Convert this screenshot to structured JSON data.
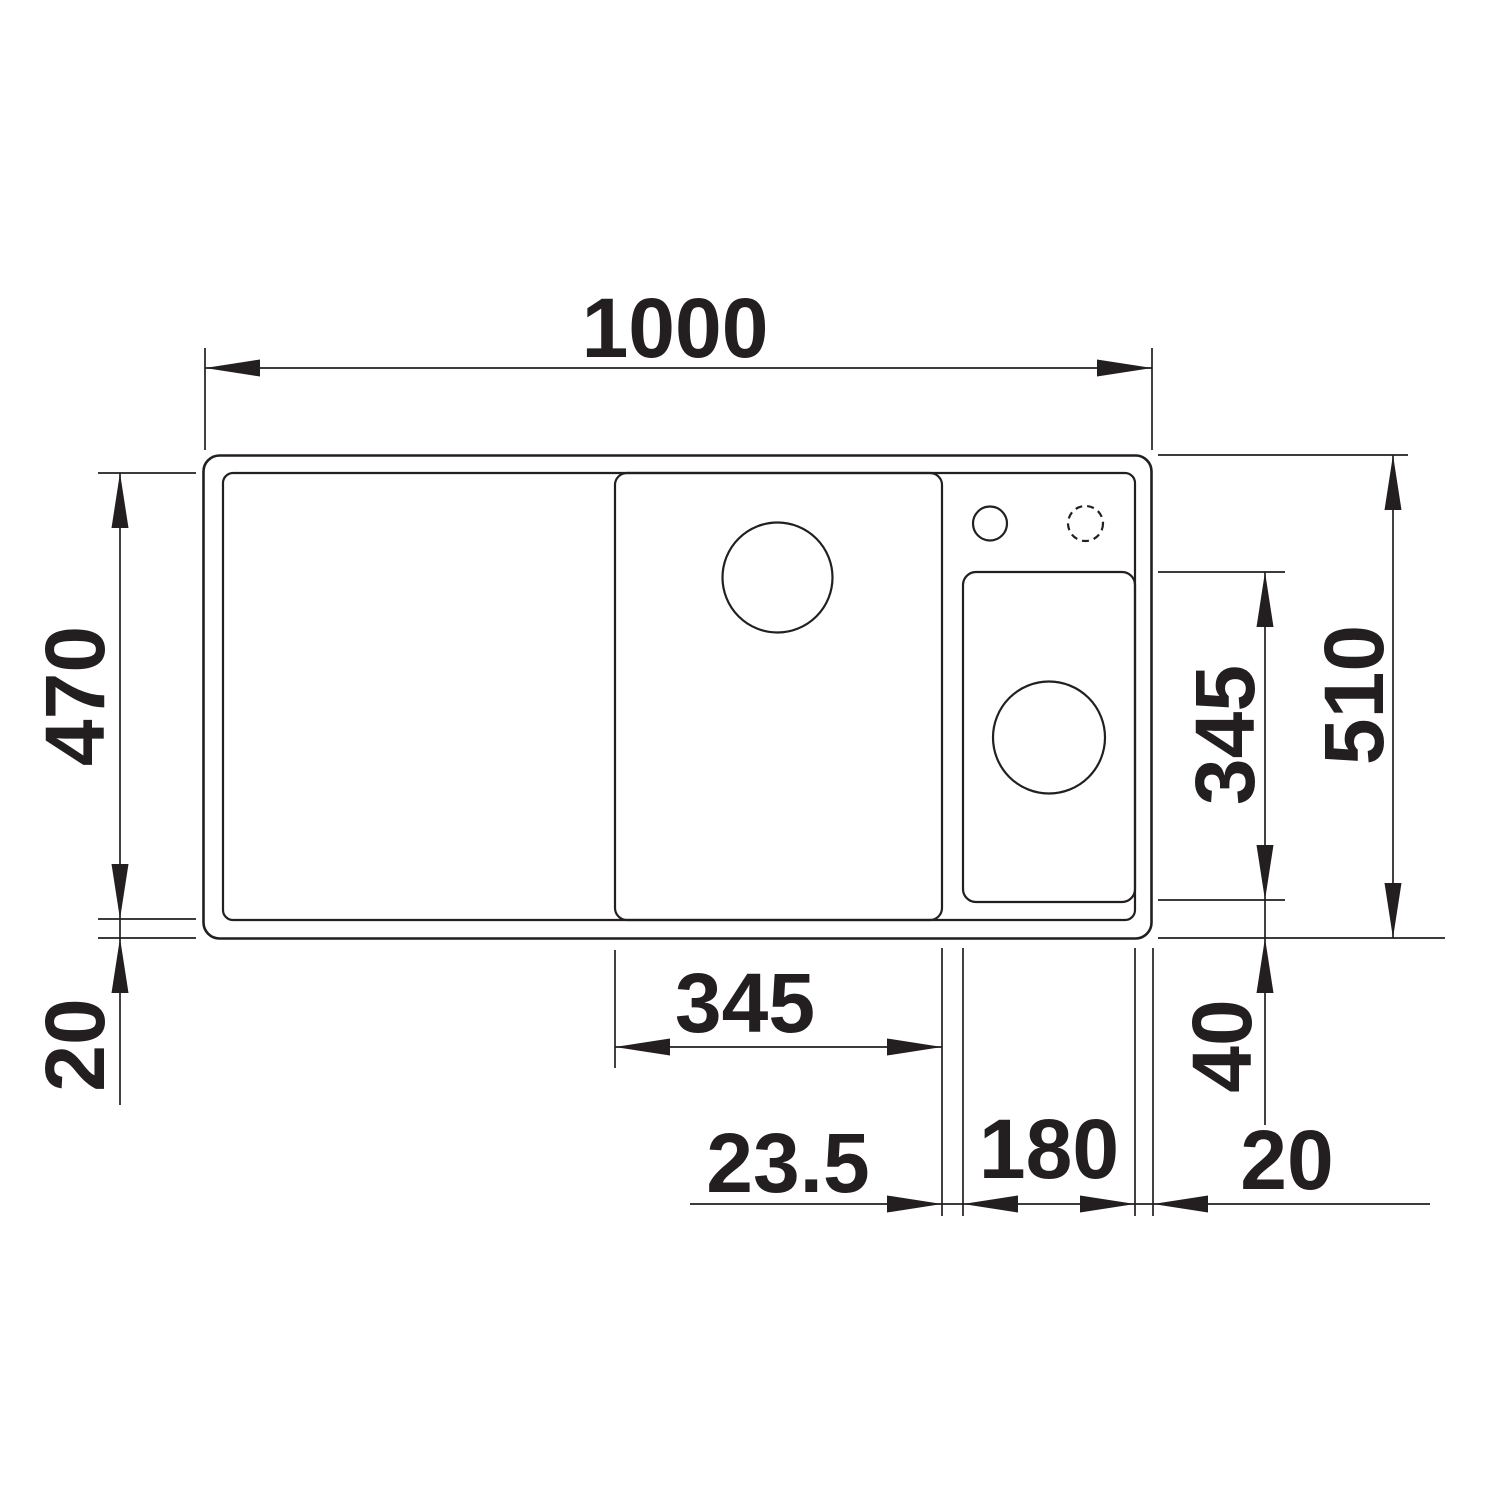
{
  "page": {
    "background_color": "#ffffff"
  },
  "drawing": {
    "kind": "kitchen-sink-top-view-dimensioned-drawing",
    "line_color": "#231f20",
    "dimensions": {
      "overall_width": "1000",
      "rim_inner_depth": "470",
      "rim_edge_bottom_left": "20",
      "overall_depth": "510",
      "small_bowl_depth": "345",
      "small_bowl_bottom_offset": "40",
      "main_bowl_width": "345",
      "divider_width": "23.5",
      "small_bowl_width": "180",
      "rim_edge_right": "20"
    }
  }
}
